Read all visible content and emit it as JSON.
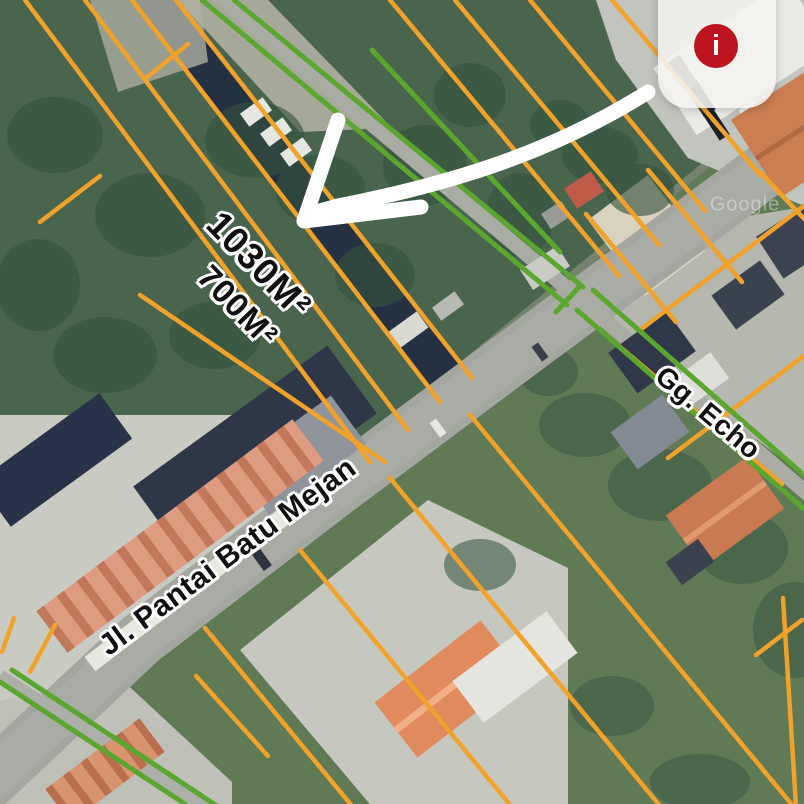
{
  "map_labels": {
    "area_primary": "1030M²",
    "area_secondary": "700M²",
    "road": "Jl. Pantai Batu Mejan",
    "lane": "Gg. Echo"
  },
  "watermark": "Google",
  "overlay": {
    "info_glyph": "i"
  },
  "colors": {
    "boundary_orange": "#f1a22a",
    "boundary_green": "#5aa62f",
    "info_red": "#bd1420",
    "arrow_white": "#ffffff",
    "road_gray": "#a4a7a0",
    "card_bg": "rgba(245,243,240,0.88)"
  }
}
